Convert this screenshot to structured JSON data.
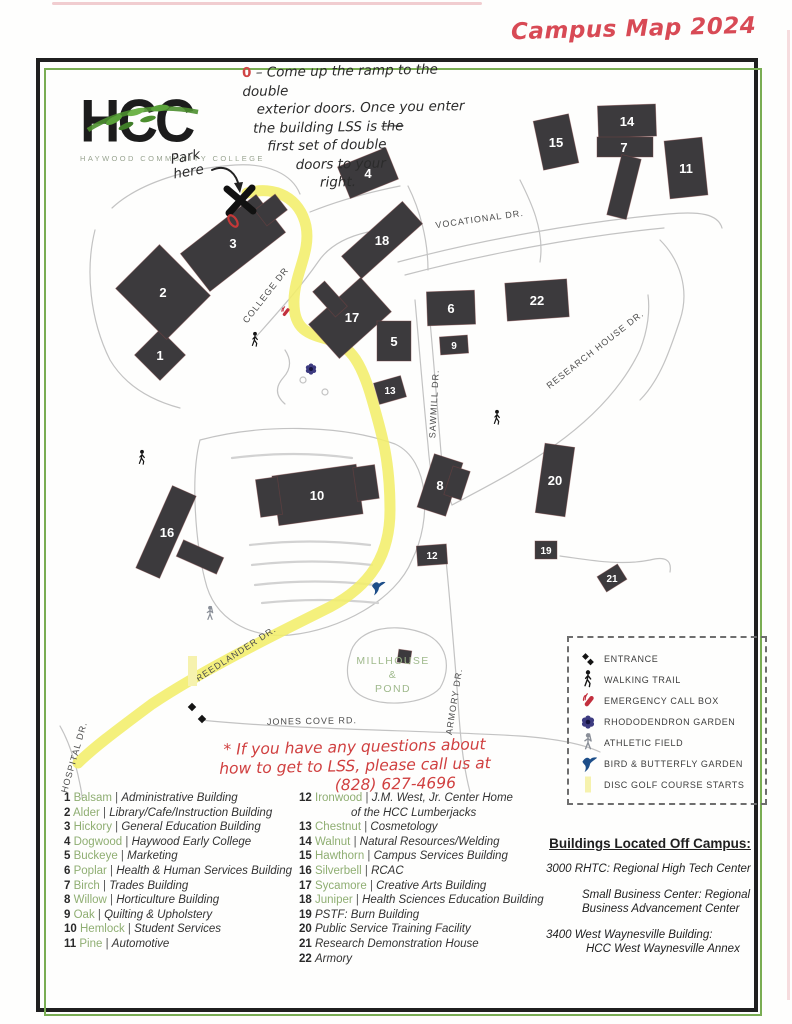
{
  "title": "Campus Map 2024",
  "logo": {
    "acronym": "HCC",
    "subtitle": "HAYWOOD COMMUNITY COLLEGE"
  },
  "annotations": {
    "top_marker": "0",
    "top_lines": {
      "l1": "– Come up the ramp to the double",
      "l2": "exterior doors. Once you enter",
      "l3a": "the building LSS is ",
      "l3b": "the",
      "l4": "first set of double",
      "l5": "doors to your",
      "l6": "right."
    },
    "park_here_l1": "Park",
    "park_here_l2": "here",
    "bottom_l1": "* If you have any questions about",
    "bottom_l2": "how to get to LSS, please call us at",
    "bottom_l3": "(828) 627-4696"
  },
  "map": {
    "roads": [
      {
        "name": "VOCATIONAL DR."
      },
      {
        "name": "COLLEGE DR"
      },
      {
        "name": "SAWMILL DR."
      },
      {
        "name": "RESEARCH HOUSE DR."
      },
      {
        "name": "FREEDLANDER DR."
      },
      {
        "name": "JONES COVE RD."
      },
      {
        "name": "ARMORY DR."
      },
      {
        "name": "HOSPITAL DR."
      }
    ],
    "area_label": {
      "l1": "MILLHOUSE",
      "l2": "&",
      "l3": "POND"
    },
    "buildings": [
      {
        "number": "1"
      },
      {
        "number": "2"
      },
      {
        "number": "3"
      },
      {
        "number": "4"
      },
      {
        "number": "5"
      },
      {
        "number": "6"
      },
      {
        "number": "7"
      },
      {
        "number": "8"
      },
      {
        "number": "9"
      },
      {
        "number": "10"
      },
      {
        "number": "11"
      },
      {
        "number": "12"
      },
      {
        "number": "13"
      },
      {
        "number": "14"
      },
      {
        "number": "15"
      },
      {
        "number": "16"
      },
      {
        "number": "17"
      },
      {
        "number": "18"
      },
      {
        "number": "19"
      },
      {
        "number": "20"
      },
      {
        "number": "21"
      },
      {
        "number": "22"
      }
    ]
  },
  "legend": {
    "items": [
      {
        "icon": "entrance-icon",
        "label": "ENTRANCE"
      },
      {
        "icon": "walking-trail-icon",
        "label": "WALKING TRAIL"
      },
      {
        "icon": "emergency-call-box-icon",
        "label": "EMERGENCY CALL BOX"
      },
      {
        "icon": "rhododendron-garden-icon",
        "label": "RHODODENDRON GARDEN"
      },
      {
        "icon": "athletic-field-icon",
        "label": "ATHLETIC FIELD"
      },
      {
        "icon": "bird-butterfly-garden-icon",
        "label": "BIRD & BUTTERFLY GARDEN"
      },
      {
        "icon": "disc-golf-icon",
        "label": "DISC GOLF COURSE STARTS"
      }
    ]
  },
  "directory": {
    "col1": [
      {
        "num": "1",
        "name": "Balsam",
        "desc": "Administrative Building"
      },
      {
        "num": "2",
        "name": "Alder",
        "desc": "Library/Cafe/Instruction Building"
      },
      {
        "num": "3",
        "name": "Hickory",
        "desc": "General Education Building"
      },
      {
        "num": "4",
        "name": "Dogwood",
        "desc": "Haywood Early College"
      },
      {
        "num": "5",
        "name": "Buckeye",
        "desc": "Marketing"
      },
      {
        "num": "6",
        "name": "Poplar",
        "desc": "Health & Human Services Building"
      },
      {
        "num": "7",
        "name": "Birch",
        "desc": "Trades Building"
      },
      {
        "num": "8",
        "name": "Willow",
        "desc": "Horticulture Building"
      },
      {
        "num": "9",
        "name": "Oak",
        "desc": "Quilting & Upholstery"
      },
      {
        "num": "10",
        "name": "Hemlock",
        "desc": "Student Services"
      },
      {
        "num": "11",
        "name": "Pine",
        "desc": "Automotive"
      }
    ],
    "col2": [
      {
        "num": "12",
        "name": "Ironwood",
        "desc": "J.M. West, Jr. Center Home",
        "desc2": "of the HCC Lumberjacks"
      },
      {
        "num": "13",
        "name": "Chestnut",
        "desc": "Cosmetology"
      },
      {
        "num": "14",
        "name": "Walnut",
        "desc": "Natural Resources/Welding"
      },
      {
        "num": "15",
        "name": "Hawthorn",
        "desc": "Campus Services Building"
      },
      {
        "num": "16",
        "name": "Silverbell",
        "desc": "RCAC"
      },
      {
        "num": "17",
        "name": "Sycamore",
        "desc": "Creative Arts Building"
      },
      {
        "num": "18",
        "name": "Juniper",
        "desc": "Health Sciences Education Building"
      },
      {
        "num": "19",
        "desc": "PSTF: Burn Building"
      },
      {
        "num": "20",
        "desc": "Public Service Training Facility"
      },
      {
        "num": "21",
        "desc": "Research Demonstration House"
      },
      {
        "num": "22",
        "desc": "Armory"
      }
    ],
    "off_campus": {
      "heading": "Buildings Located Off Campus:",
      "entries": [
        {
          "l1": "3000 RHTC: Regional High Tech Center",
          "l2": ""
        },
        {
          "l1": "Small Business Center: Regional",
          "l2": "Business Advancement Center"
        },
        {
          "l1": "3400 West Waynesville Building:",
          "l2": "HCC West Waynesville Annex"
        }
      ]
    }
  },
  "colors": {
    "route_yellow": "#f2ee6a",
    "building_fill": "#3c3a3d",
    "tree_green": "#8fae72",
    "handwriting_red": "#d04545",
    "title_red": "#d84a55",
    "bird_blue": "#1d4e89",
    "call_box_red": "#c22f3d",
    "garden_purple": "#3d3b80",
    "frame_green": "#79ad53"
  }
}
